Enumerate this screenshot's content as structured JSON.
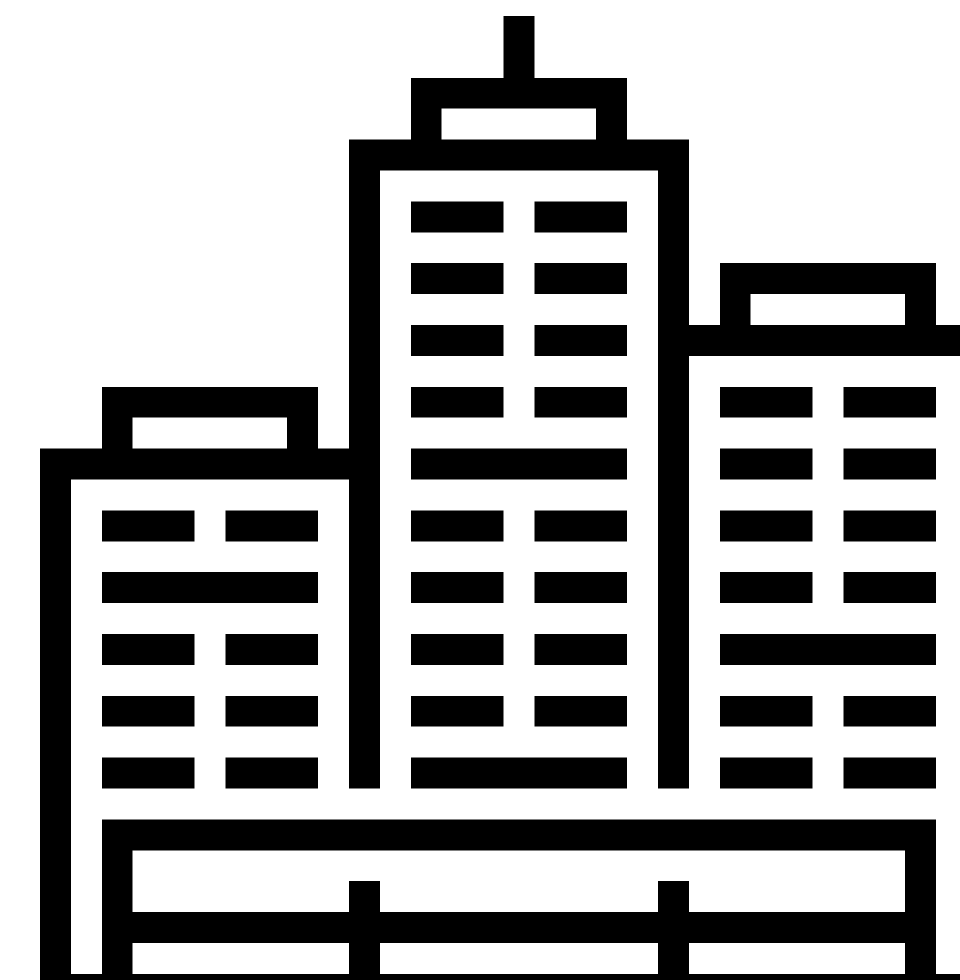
{
  "canvas": {
    "width": 960,
    "height": 980,
    "unit": 30.9
  },
  "colors": {
    "foreground": "#000000",
    "background": "#ffffff"
  },
  "icon": {
    "name": "city-skyline-buildings-icon",
    "description": "Monochrome pictogram of three high-rise buildings with grid windows standing behind a fenced platform",
    "elements": [
      {
        "name": "center-antenna",
        "rect": [
          15,
          0,
          1,
          2
        ]
      },
      {
        "name": "center-roof-top",
        "rect": [
          12,
          2,
          7,
          1
        ]
      },
      {
        "name": "center-roof-left",
        "rect": [
          12,
          3,
          1,
          1
        ]
      },
      {
        "name": "center-roof-right",
        "rect": [
          18,
          3,
          1,
          1
        ]
      },
      {
        "name": "center-parapet",
        "rect": [
          10,
          4,
          11,
          1
        ]
      },
      {
        "name": "center-wall-left",
        "rect": [
          10,
          5,
          1,
          20
        ]
      },
      {
        "name": "center-wall-right",
        "rect": [
          20,
          5,
          1,
          20
        ]
      },
      {
        "name": "center-window",
        "rect": [
          12,
          6,
          3,
          1
        ]
      },
      {
        "name": "center-window",
        "rect": [
          16,
          6,
          3,
          1
        ]
      },
      {
        "name": "center-window",
        "rect": [
          12,
          8,
          3,
          1
        ]
      },
      {
        "name": "center-window",
        "rect": [
          16,
          8,
          3,
          1
        ]
      },
      {
        "name": "center-window",
        "rect": [
          12,
          10,
          3,
          1
        ]
      },
      {
        "name": "center-window",
        "rect": [
          16,
          10,
          3,
          1
        ]
      },
      {
        "name": "center-window",
        "rect": [
          12,
          12,
          3,
          1
        ]
      },
      {
        "name": "center-window",
        "rect": [
          16,
          12,
          3,
          1
        ]
      },
      {
        "name": "center-window-band",
        "rect": [
          12,
          14,
          7,
          1
        ]
      },
      {
        "name": "center-window",
        "rect": [
          12,
          16,
          3,
          1
        ]
      },
      {
        "name": "center-window",
        "rect": [
          16,
          16,
          3,
          1
        ]
      },
      {
        "name": "center-window",
        "rect": [
          12,
          18,
          3,
          1
        ]
      },
      {
        "name": "center-window",
        "rect": [
          16,
          18,
          3,
          1
        ]
      },
      {
        "name": "center-window",
        "rect": [
          12,
          20,
          3,
          1
        ]
      },
      {
        "name": "center-window",
        "rect": [
          16,
          20,
          3,
          1
        ]
      },
      {
        "name": "center-window",
        "rect": [
          12,
          22,
          3,
          1
        ]
      },
      {
        "name": "center-window",
        "rect": [
          16,
          22,
          3,
          1
        ]
      },
      {
        "name": "center-window-band",
        "rect": [
          12,
          24,
          7,
          1
        ]
      },
      {
        "name": "left-roof-top",
        "rect": [
          2,
          12,
          7,
          1
        ]
      },
      {
        "name": "left-roof-left",
        "rect": [
          2,
          13,
          1,
          1
        ]
      },
      {
        "name": "left-roof-right",
        "rect": [
          8,
          13,
          1,
          1
        ]
      },
      {
        "name": "left-parapet",
        "rect": [
          0,
          14,
          10,
          1
        ]
      },
      {
        "name": "left-wall-outer",
        "rect": [
          0,
          15,
          1,
          17
        ]
      },
      {
        "name": "left-window",
        "rect": [
          2,
          16,
          3,
          1
        ]
      },
      {
        "name": "left-window",
        "rect": [
          6,
          16,
          3,
          1
        ]
      },
      {
        "name": "left-window-band",
        "rect": [
          2,
          18,
          7,
          1
        ]
      },
      {
        "name": "left-window",
        "rect": [
          2,
          20,
          3,
          1
        ]
      },
      {
        "name": "left-window",
        "rect": [
          6,
          20,
          3,
          1
        ]
      },
      {
        "name": "left-window",
        "rect": [
          2,
          22,
          3,
          1
        ]
      },
      {
        "name": "left-window",
        "rect": [
          6,
          22,
          3,
          1
        ]
      },
      {
        "name": "left-window",
        "rect": [
          2,
          24,
          3,
          1
        ]
      },
      {
        "name": "left-window",
        "rect": [
          6,
          24,
          3,
          1
        ]
      },
      {
        "name": "right-roof-top",
        "rect": [
          22,
          8,
          7,
          1
        ]
      },
      {
        "name": "right-roof-left",
        "rect": [
          22,
          9,
          1,
          1
        ]
      },
      {
        "name": "right-roof-right",
        "rect": [
          28,
          9,
          1,
          1
        ]
      },
      {
        "name": "right-parapet",
        "rect": [
          21,
          10,
          10,
          1
        ]
      },
      {
        "name": "right-wall-outer",
        "rect": [
          30,
          11,
          1,
          21
        ]
      },
      {
        "name": "right-window",
        "rect": [
          22,
          12,
          3,
          1
        ]
      },
      {
        "name": "right-window",
        "rect": [
          26,
          12,
          3,
          1
        ]
      },
      {
        "name": "right-window",
        "rect": [
          22,
          14,
          3,
          1
        ]
      },
      {
        "name": "right-window",
        "rect": [
          26,
          14,
          3,
          1
        ]
      },
      {
        "name": "right-window",
        "rect": [
          22,
          16,
          3,
          1
        ]
      },
      {
        "name": "right-window",
        "rect": [
          26,
          16,
          3,
          1
        ]
      },
      {
        "name": "right-window",
        "rect": [
          22,
          18,
          3,
          1
        ]
      },
      {
        "name": "right-window",
        "rect": [
          26,
          18,
          3,
          1
        ]
      },
      {
        "name": "right-window-band",
        "rect": [
          22,
          20,
          7,
          1
        ]
      },
      {
        "name": "right-window",
        "rect": [
          22,
          22,
          3,
          1
        ]
      },
      {
        "name": "right-window",
        "rect": [
          26,
          22,
          3,
          1
        ]
      },
      {
        "name": "right-window",
        "rect": [
          22,
          24,
          3,
          1
        ]
      },
      {
        "name": "right-window",
        "rect": [
          26,
          24,
          3,
          1
        ]
      },
      {
        "name": "platform-deck",
        "rect": [
          2,
          26,
          27,
          1
        ]
      },
      {
        "name": "platform-leg-left",
        "rect": [
          2,
          27,
          1,
          5
        ]
      },
      {
        "name": "platform-leg-right",
        "rect": [
          28,
          27,
          1,
          5
        ]
      },
      {
        "name": "fence-post-left",
        "rect": [
          10,
          28,
          1,
          4
        ]
      },
      {
        "name": "fence-post-right",
        "rect": [
          20,
          28,
          1,
          4
        ]
      },
      {
        "name": "fence-rail",
        "rect": [
          2,
          29,
          27,
          1
        ]
      },
      {
        "name": "ground-bar",
        "rect": [
          0,
          31,
          31,
          1
        ]
      }
    ]
  }
}
